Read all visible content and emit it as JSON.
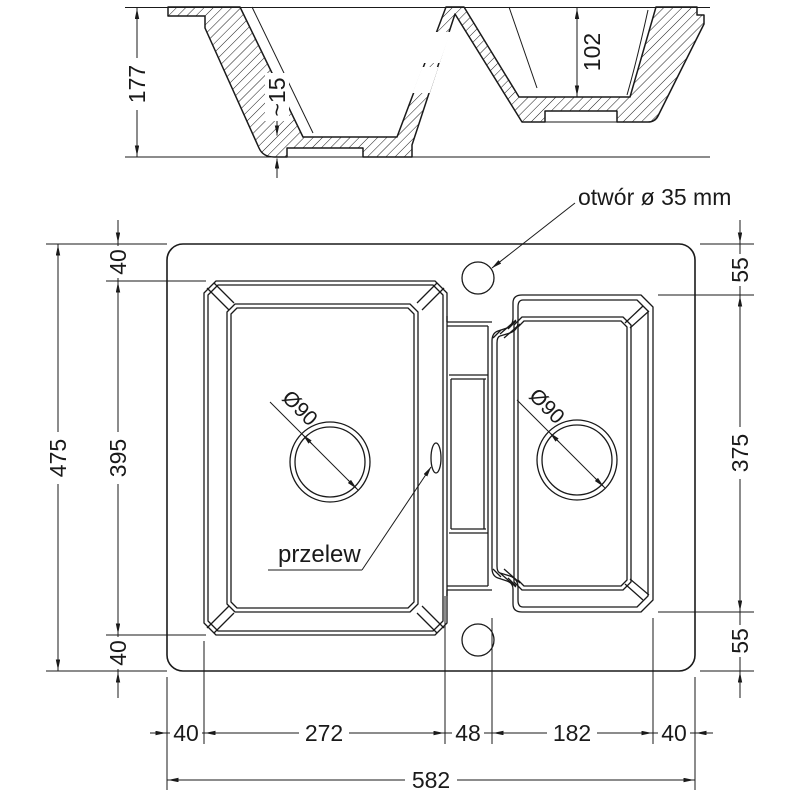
{
  "section": {
    "dim_total_depth": "177",
    "dim_floor_thickness": "~15",
    "dim_right_bowl_depth": "102"
  },
  "plan": {
    "hole_label": "otwór ø 35 mm",
    "overflow_label": "przelew",
    "drain_left_label": "Ø90",
    "drain_right_label": "Ø90",
    "left": {
      "overall": "475",
      "top": "40",
      "bowl": "395",
      "bottom": "40"
    },
    "right": {
      "top": "55",
      "bowl": "375",
      "bottom": "55"
    },
    "bottom": {
      "left_margin": "40",
      "left_bowl": "272",
      "divider": "48",
      "right_bowl": "182",
      "right_margin": "40",
      "overall": "582"
    }
  },
  "colors": {
    "line": "#1a1a1a",
    "background": "#ffffff"
  }
}
